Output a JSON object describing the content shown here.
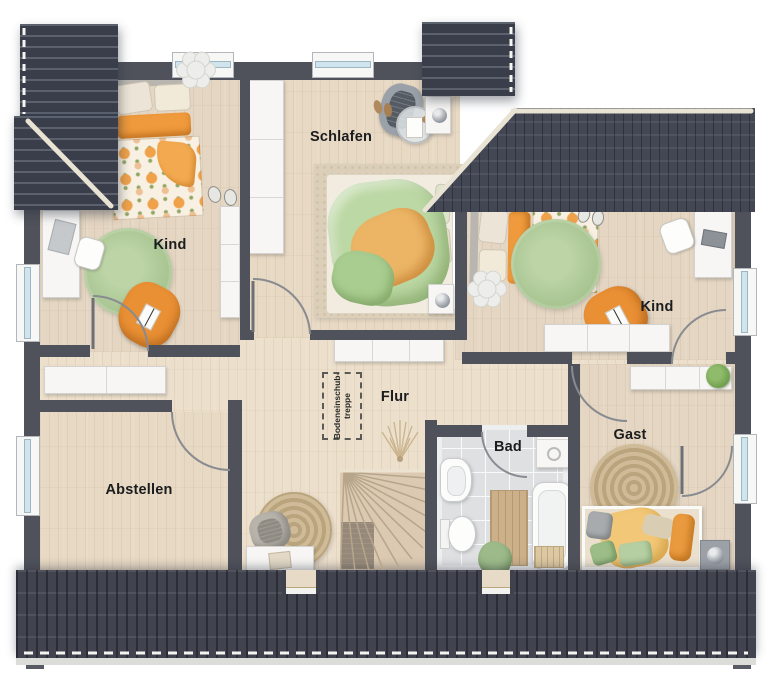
{
  "plan_title": "Dachgeschoss Grundriss",
  "rooms": [
    {
      "id": "kind-left",
      "label": "Kind"
    },
    {
      "id": "schlafen",
      "label": "Schlafen"
    },
    {
      "id": "kind-right",
      "label": "Kind"
    },
    {
      "id": "flur",
      "label": "Flur"
    },
    {
      "id": "bad",
      "label": "Bad"
    },
    {
      "id": "gast",
      "label": "Gast"
    },
    {
      "id": "abstellen",
      "label": "Abstellen"
    }
  ],
  "annotations": {
    "attic_hatch_line1": "Bodeneinschub-",
    "attic_hatch_line2": "treppe"
  },
  "colors": {
    "roof_dark": "#3a3e4a",
    "wall_gray": "#4f525a",
    "floor_wood": "#e4d6c2",
    "bath_tile": "#dfe0e2",
    "ridge_cream": "#e9e3d4",
    "accent_orange": "#ec9a41",
    "accent_green": "#aec897",
    "window_glass": "#cfe4ec"
  }
}
